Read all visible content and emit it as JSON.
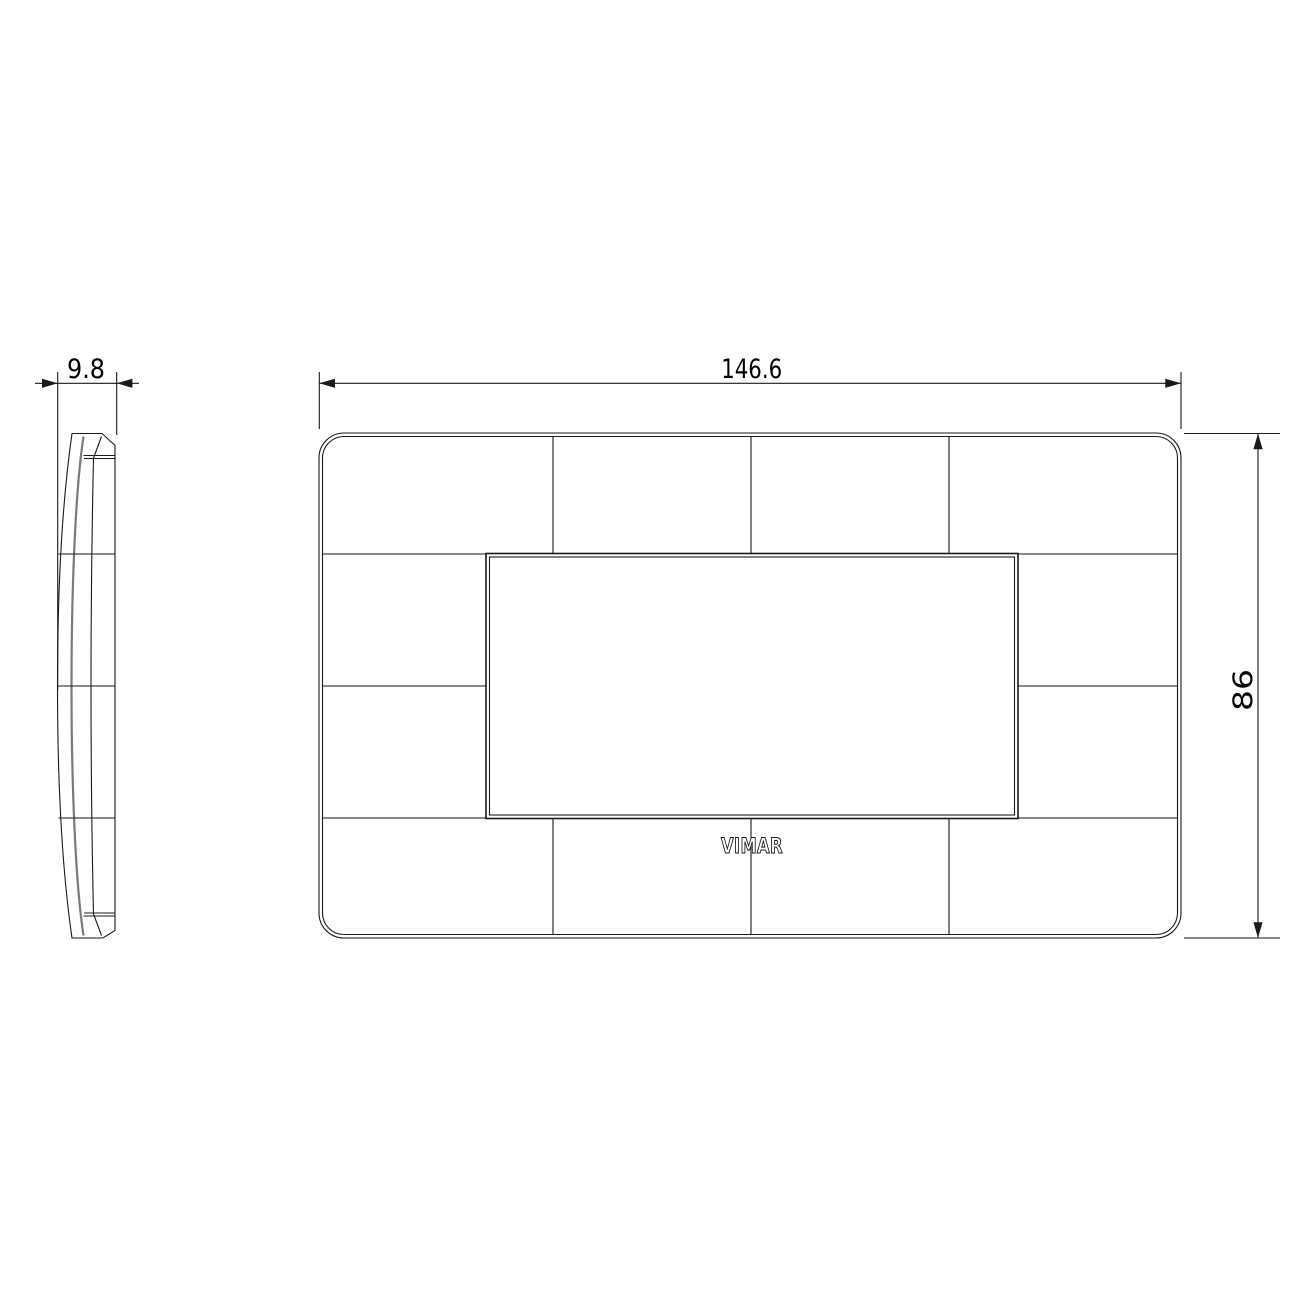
{
  "colors": {
    "background": "#ffffff",
    "line": "#1a1a1a",
    "soft_line": "#7a7a7a",
    "text": "#000000"
  },
  "dimensions": {
    "depth_label": "9.8",
    "width_label": "146.6",
    "height_label": "86"
  },
  "logo_text": "VIMAR"
}
